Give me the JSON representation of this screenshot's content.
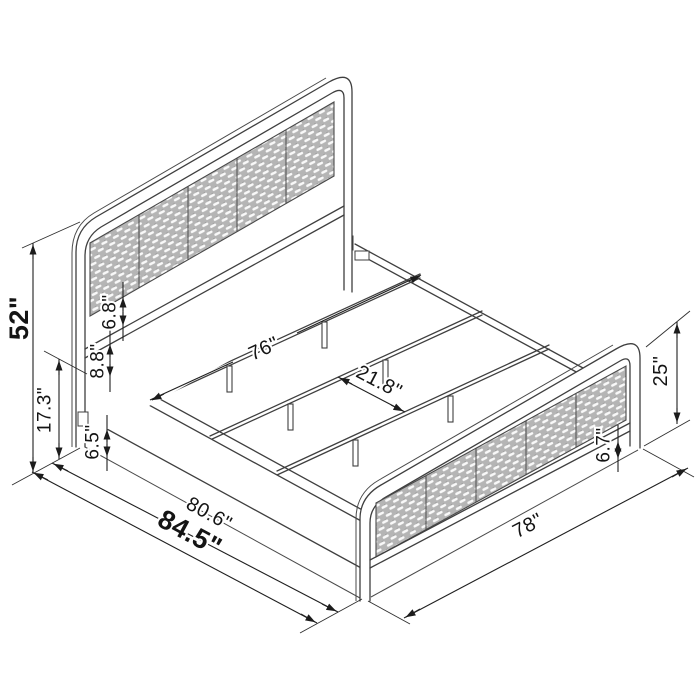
{
  "dimensions": {
    "headboard_height": "52\"",
    "frame_height": "17.3\"",
    "panel_to_rail_gap": "6.8\"",
    "rail_to_frame_gap": "8.8\"",
    "underbed_clearance": "6.5\"",
    "slat_length": "76\"",
    "slat_spacing": "21.8\"",
    "inner_length": "80.6\"",
    "overall_length": "84.5\"",
    "overall_width": "78\"",
    "footboard_height": "25\"",
    "footboard_clearance": "6.7\""
  },
  "colors": {
    "background": "#ffffff",
    "structure_line": "#3f3f3f",
    "dimension_line": "#1f1f1f",
    "label_text": "#141414",
    "cane_panel_fill": "#b5b5b5",
    "cane_weave": "#ffffff"
  }
}
